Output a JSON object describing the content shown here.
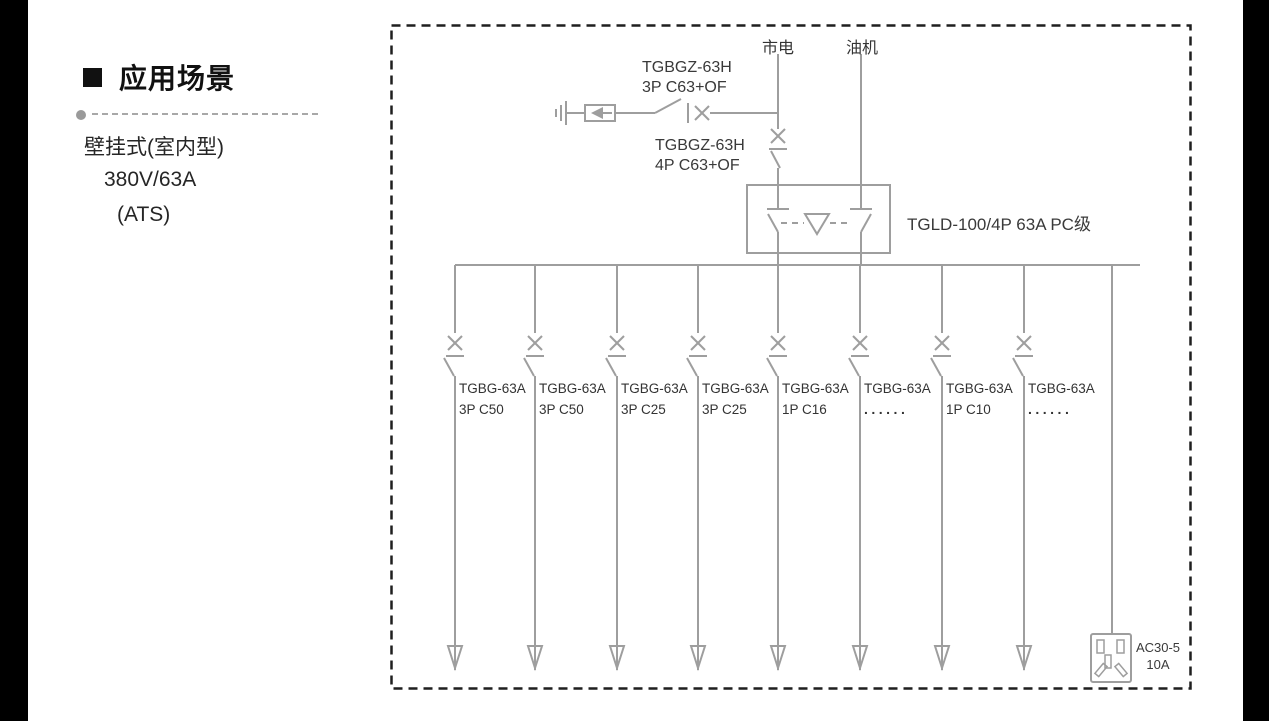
{
  "sidebar": {
    "title": "应用场景",
    "items": [
      "壁挂式(室内型)",
      "380V/63A",
      "(ATS)"
    ]
  },
  "diagram": {
    "sources": [
      {
        "label": "市电"
      },
      {
        "label": "油机"
      }
    ],
    "spd_breaker_label": {
      "line1": "TGBGZ-63H",
      "line2": "3P C63+OF"
    },
    "main_breaker_label": {
      "line1": "TGBGZ-63H",
      "line2": "4P C63+OF"
    },
    "ats_label": "TGLD-100/4P 63A PC级",
    "branches": [
      {
        "model": "TGBG-63A",
        "spec": "3P C50"
      },
      {
        "model": "TGBG-63A",
        "spec": "3P C50"
      },
      {
        "model": "TGBG-63A",
        "spec": "3P C25"
      },
      {
        "model": "TGBG-63A",
        "spec": "3P C25"
      },
      {
        "model": "TGBG-63A",
        "spec": "1P C16"
      },
      {
        "model": "TGBG-63A",
        "spec": "......"
      },
      {
        "model": "TGBG-63A",
        "spec": "1P C10"
      },
      {
        "model": "TGBG-63A",
        "spec": "......"
      }
    ],
    "socket": {
      "line1": "AC30-5",
      "line2": "10A"
    },
    "colors": {
      "line": "#9e9e9e",
      "border": "#1f1f1f",
      "text": "#3a3a3a"
    }
  }
}
